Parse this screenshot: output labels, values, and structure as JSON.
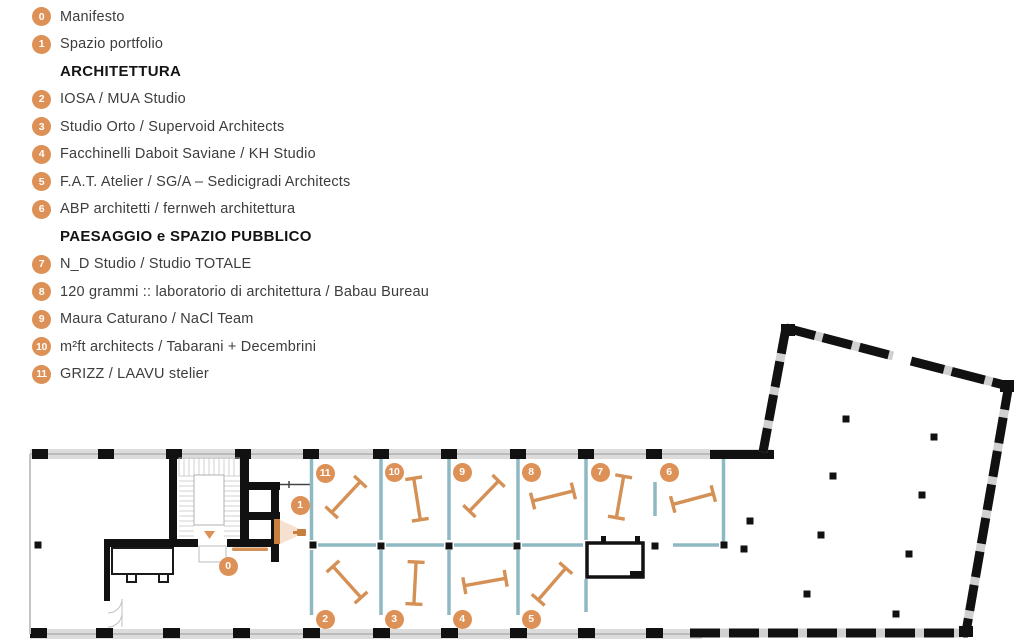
{
  "title": "exhibition floor plan with studio legend",
  "colors": {
    "accent_orange": "#dd9156",
    "furniture_orange": "#d59055",
    "screen_orange": "#c5803f",
    "partition_teal": "#8fb9c2",
    "wall_black": "#111111",
    "band_gray": "#dcdcdc",
    "text_dark": "#3d3d3d"
  },
  "legend": {
    "items": [
      {
        "type": "entry",
        "badge": "0",
        "label": "Manifesto"
      },
      {
        "type": "entry",
        "badge": "1",
        "label": "Spazio portfolio"
      },
      {
        "type": "header",
        "label": "ARCHITETTURA"
      },
      {
        "type": "entry",
        "badge": "2",
        "label": "IOSA / MUA Studio"
      },
      {
        "type": "entry",
        "badge": "3",
        "label": "Studio Orto / Supervoid Architects"
      },
      {
        "type": "entry",
        "badge": "4",
        "label": "Facchinelli Daboit Saviane / KH Studio"
      },
      {
        "type": "entry",
        "badge": "5",
        "label": "F.A.T. Atelier / SG/A – Sedicigradi Architects"
      },
      {
        "type": "entry",
        "badge": "6",
        "label": "ABP architetti / fernweh architettura"
      },
      {
        "type": "header",
        "label": "PAESAGGIO e SPAZIO PUBBLICO"
      },
      {
        "type": "entry",
        "badge": "7",
        "label": "N_D Studio / Studio TOTALE"
      },
      {
        "type": "entry",
        "badge": "8",
        "label": "120 grammi :: laboratorio di architettura / Babau Bureau"
      },
      {
        "type": "entry",
        "badge": "9",
        "label": "Maura Caturano / NaCl Team"
      },
      {
        "type": "entry",
        "badge": "10",
        "label": "m²ft architects / Tabarani + Decembrini"
      },
      {
        "type": "entry",
        "badge": "11",
        "label": "GRIZZ / LAAVU stelier"
      }
    ]
  },
  "floor_plan": {
    "markers": [
      {
        "label": "0",
        "x": 228,
        "y": 566
      },
      {
        "label": "1",
        "x": 300,
        "y": 505
      },
      {
        "label": "2",
        "x": 325,
        "y": 619
      },
      {
        "label": "3",
        "x": 394,
        "y": 619
      },
      {
        "label": "4",
        "x": 462,
        "y": 619
      },
      {
        "label": "5",
        "x": 531,
        "y": 619
      },
      {
        "label": "6",
        "x": 669,
        "y": 472
      },
      {
        "label": "7",
        "x": 600,
        "y": 472
      },
      {
        "label": "8",
        "x": 531,
        "y": 472
      },
      {
        "label": "9",
        "x": 462,
        "y": 472
      },
      {
        "label": "10",
        "x": 394,
        "y": 472
      },
      {
        "label": "11",
        "x": 325,
        "y": 473
      }
    ],
    "tables": [
      {
        "x": 346,
        "y": 497,
        "a": -47
      },
      {
        "x": 417,
        "y": 499,
        "a": 81
      },
      {
        "x": 484,
        "y": 496,
        "a": -46
      },
      {
        "x": 553,
        "y": 496,
        "a": -14
      },
      {
        "x": 620,
        "y": 497,
        "a": 100
      },
      {
        "x": 693,
        "y": 499,
        "a": -15
      },
      {
        "x": 347,
        "y": 582,
        "a": 48
      },
      {
        "x": 415,
        "y": 583,
        "a": 93
      },
      {
        "x": 485,
        "y": 582,
        "a": -10
      },
      {
        "x": 552,
        "y": 584,
        "a": -49
      }
    ],
    "columns": [
      {
        "x": 38,
        "y": 545
      },
      {
        "x": 313,
        "y": 545
      },
      {
        "x": 381,
        "y": 546
      },
      {
        "x": 449,
        "y": 546
      },
      {
        "x": 517,
        "y": 546
      },
      {
        "x": 655,
        "y": 546
      },
      {
        "x": 724,
        "y": 545
      },
      {
        "x": 744,
        "y": 549
      },
      {
        "x": 846,
        "y": 419
      },
      {
        "x": 934,
        "y": 437
      },
      {
        "x": 833,
        "y": 476
      },
      {
        "x": 922,
        "y": 495
      },
      {
        "x": 750,
        "y": 521
      },
      {
        "x": 821,
        "y": 535
      },
      {
        "x": 909,
        "y": 554
      },
      {
        "x": 807,
        "y": 594
      },
      {
        "x": 896,
        "y": 614
      }
    ]
  }
}
